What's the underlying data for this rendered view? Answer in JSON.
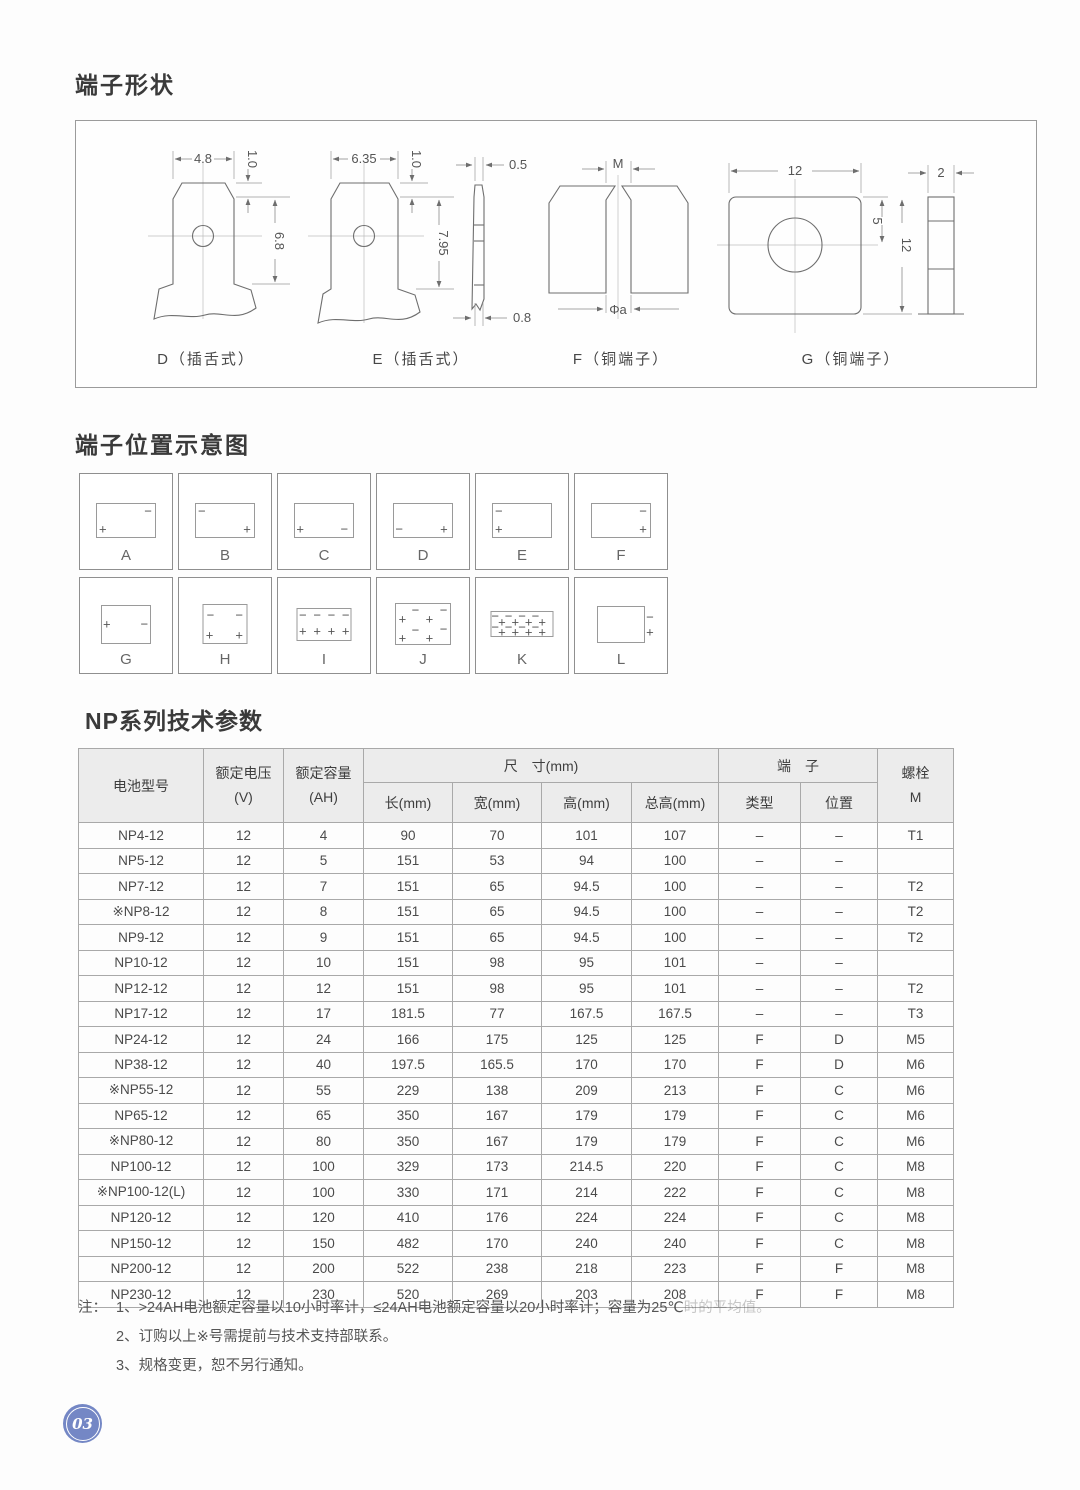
{
  "page": {
    "number": "03",
    "badge_color": "#7487c5"
  },
  "shapes": {
    "title": "端子形状",
    "d": {
      "caption": "D（插舌式）",
      "w": "4.8",
      "t": "1.0",
      "h": "6.8"
    },
    "e": {
      "caption": "E（插舌式）",
      "w": "6.35",
      "t": "1.0",
      "h": "7.95",
      "side_top": "0.5",
      "side_bottom": "0.8"
    },
    "f": {
      "caption": "F（铜端子）",
      "thread": "M",
      "hole": "Φa"
    },
    "g": {
      "caption": "G（铜端子）",
      "w": "12",
      "offset": "5",
      "h": "12",
      "side": "2"
    }
  },
  "positions": {
    "title": "端子位置示意图",
    "rows": [
      [
        {
          "label": "A",
          "bw": 60,
          "bh": 35,
          "marks": [
            {
              "c": "+",
              "x": 10,
              "y": 78
            },
            {
              "c": "−",
              "x": 88,
              "y": 22
            }
          ]
        },
        {
          "label": "B",
          "bw": 60,
          "bh": 35,
          "marks": [
            {
              "c": "−",
              "x": 10,
              "y": 22
            },
            {
              "c": "+",
              "x": 88,
              "y": 78
            }
          ]
        },
        {
          "label": "C",
          "bw": 60,
          "bh": 35,
          "marks": [
            {
              "c": "+",
              "x": 9,
              "y": 76
            },
            {
              "c": "−",
              "x": 85,
              "y": 76
            }
          ]
        },
        {
          "label": "D",
          "bw": 60,
          "bh": 35,
          "marks": [
            {
              "c": "−",
              "x": 9,
              "y": 76
            },
            {
              "c": "+",
              "x": 86,
              "y": 76
            }
          ]
        },
        {
          "label": "E",
          "bw": 60,
          "bh": 35,
          "marks": [
            {
              "c": "−",
              "x": 10,
              "y": 22
            },
            {
              "c": "+",
              "x": 10,
              "y": 78
            }
          ]
        },
        {
          "label": "F",
          "bw": 60,
          "bh": 35,
          "marks": [
            {
              "c": "−",
              "x": 88,
              "y": 22
            },
            {
              "c": "+",
              "x": 88,
              "y": 78
            }
          ]
        }
      ],
      [
        {
          "label": "G",
          "bw": 50,
          "bh": 39,
          "marks": [
            {
              "c": "+",
              "x": 10,
              "y": 50
            },
            {
              "c": "−",
              "x": 88,
              "y": 50
            }
          ]
        },
        {
          "label": "H",
          "bw": 45,
          "bh": 40,
          "marks": [
            {
              "c": "−",
              "x": 16,
              "y": 26
            },
            {
              "c": "−",
              "x": 83,
              "y": 26
            },
            {
              "c": "+",
              "x": 14,
              "y": 80
            },
            {
              "c": "+",
              "x": 83,
              "y": 80
            }
          ]
        },
        {
          "label": "I",
          "bw": 55,
          "bh": 33,
          "marks": [
            {
              "c": "−",
              "x": 10,
              "y": 22
            },
            {
              "c": "−",
              "x": 37,
              "y": 22
            },
            {
              "c": "−",
              "x": 64,
              "y": 22
            },
            {
              "c": "−",
              "x": 91,
              "y": 22
            },
            {
              "c": "+",
              "x": 10,
              "y": 74
            },
            {
              "c": "+",
              "x": 37,
              "y": 74
            },
            {
              "c": "+",
              "x": 64,
              "y": 74
            },
            {
              "c": "+",
              "x": 91,
              "y": 74
            }
          ]
        },
        {
          "label": "J",
          "bw": 56,
          "bh": 42,
          "marks": [
            {
              "c": "+",
              "x": 12,
              "y": 38
            },
            {
              "c": "−",
              "x": 36,
              "y": 16
            },
            {
              "c": "+",
              "x": 62,
              "y": 38
            },
            {
              "c": "−",
              "x": 88,
              "y": 14
            },
            {
              "c": "+",
              "x": 12,
              "y": 86
            },
            {
              "c": "−",
              "x": 36,
              "y": 64
            },
            {
              "c": "+",
              "x": 62,
              "y": 86
            },
            {
              "c": "−",
              "x": 88,
              "y": 62
            }
          ]
        },
        {
          "label": "K",
          "bw": 63,
          "bh": 26,
          "marks": [
            {
              "c": "−",
              "x": 6,
              "y": 18
            },
            {
              "c": "+",
              "x": 17,
              "y": 42
            },
            {
              "c": "−",
              "x": 28,
              "y": 18
            },
            {
              "c": "+",
              "x": 39,
              "y": 42
            },
            {
              "c": "−",
              "x": 50,
              "y": 18
            },
            {
              "c": "+",
              "x": 61,
              "y": 42
            },
            {
              "c": "−",
              "x": 72,
              "y": 18
            },
            {
              "c": "+",
              "x": 83,
              "y": 42
            },
            {
              "c": "−",
              "x": 6,
              "y": 62
            },
            {
              "c": "+",
              "x": 17,
              "y": 84
            },
            {
              "c": "−",
              "x": 28,
              "y": 62
            },
            {
              "c": "+",
              "x": 39,
              "y": 84
            },
            {
              "c": "−",
              "x": 50,
              "y": 62
            },
            {
              "c": "+",
              "x": 61,
              "y": 84
            },
            {
              "c": "−",
              "x": 72,
              "y": 62
            },
            {
              "c": "+",
              "x": 83,
              "y": 84
            }
          ]
        },
        {
          "label": "L",
          "bw": 48,
          "bh": 37,
          "marks": [
            {
              "c": "−",
              "x": 113,
              "y": 30
            },
            {
              "c": "+",
              "x": 113,
              "y": 72
            }
          ]
        }
      ]
    ]
  },
  "table": {
    "title": "NP系列技术参数",
    "headers": {
      "model": "电池型号",
      "voltage": [
        "额定电压",
        "(V)"
      ],
      "capacity": [
        "额定容量",
        "(AH)"
      ],
      "dims_group": "尺　寸(mm)",
      "dims": [
        "长(mm)",
        "宽(mm)",
        "高(mm)",
        "总高(mm)"
      ],
      "terminal_group": "端　子",
      "terminal": [
        "类型",
        "位置"
      ],
      "bolt": [
        "螺栓",
        "M"
      ]
    },
    "rows": [
      [
        "NP4-12",
        "12",
        "4",
        "90",
        "70",
        "101",
        "107",
        "–",
        "–",
        "T1"
      ],
      [
        "NP5-12",
        "12",
        "5",
        "151",
        "53",
        "94",
        "100",
        "–",
        "–",
        ""
      ],
      [
        "NP7-12",
        "12",
        "7",
        "151",
        "65",
        "94.5",
        "100",
        "–",
        "–",
        "T2"
      ],
      [
        "※NP8-12",
        "12",
        "8",
        "151",
        "65",
        "94.5",
        "100",
        "–",
        "–",
        "T2"
      ],
      [
        "NP9-12",
        "12",
        "9",
        "151",
        "65",
        "94.5",
        "100",
        "–",
        "–",
        "T2"
      ],
      [
        "NP10-12",
        "12",
        "10",
        "151",
        "98",
        "95",
        "101",
        "–",
        "–",
        ""
      ],
      [
        "NP12-12",
        "12",
        "12",
        "151",
        "98",
        "95",
        "101",
        "–",
        "–",
        "T2"
      ],
      [
        "NP17-12",
        "12",
        "17",
        "181.5",
        "77",
        "167.5",
        "167.5",
        "–",
        "–",
        "T3"
      ],
      [
        "NP24-12",
        "12",
        "24",
        "166",
        "175",
        "125",
        "125",
        "F",
        "D",
        "M5"
      ],
      [
        "NP38-12",
        "12",
        "40",
        "197.5",
        "165.5",
        "170",
        "170",
        "F",
        "D",
        "M6"
      ],
      [
        "※NP55-12",
        "12",
        "55",
        "229",
        "138",
        "209",
        "213",
        "F",
        "C",
        "M6"
      ],
      [
        "NP65-12",
        "12",
        "65",
        "350",
        "167",
        "179",
        "179",
        "F",
        "C",
        "M6"
      ],
      [
        "※NP80-12",
        "12",
        "80",
        "350",
        "167",
        "179",
        "179",
        "F",
        "C",
        "M6"
      ],
      [
        "NP100-12",
        "12",
        "100",
        "329",
        "173",
        "214.5",
        "220",
        "F",
        "C",
        "M8"
      ],
      [
        "※NP100-12(L)",
        "12",
        "100",
        "330",
        "171",
        "214",
        "222",
        "F",
        "C",
        "M8"
      ],
      [
        "NP120-12",
        "12",
        "120",
        "410",
        "176",
        "224",
        "224",
        "F",
        "C",
        "M8"
      ],
      [
        "NP150-12",
        "12",
        "150",
        "482",
        "170",
        "240",
        "240",
        "F",
        "C",
        "M8"
      ],
      [
        "NP200-12",
        "12",
        "200",
        "522",
        "238",
        "218",
        "223",
        "F",
        "F",
        "M8"
      ],
      [
        "NP230-12",
        "12",
        "230",
        "520",
        "269",
        "203",
        "208",
        "F",
        "F",
        "M8"
      ]
    ]
  },
  "notes": {
    "prefix": "注：",
    "items": [
      {
        "text": "1、>24AH电池额定容量以10小时率计，≤24AH电池额定容量以20小时率计；容量为25℃",
        "faded": "时的平均值。"
      },
      {
        "text": "2、订购以上※号需提前与技术支持部联系。"
      },
      {
        "text": "3、规格变更，恕不另行通知。"
      }
    ]
  }
}
